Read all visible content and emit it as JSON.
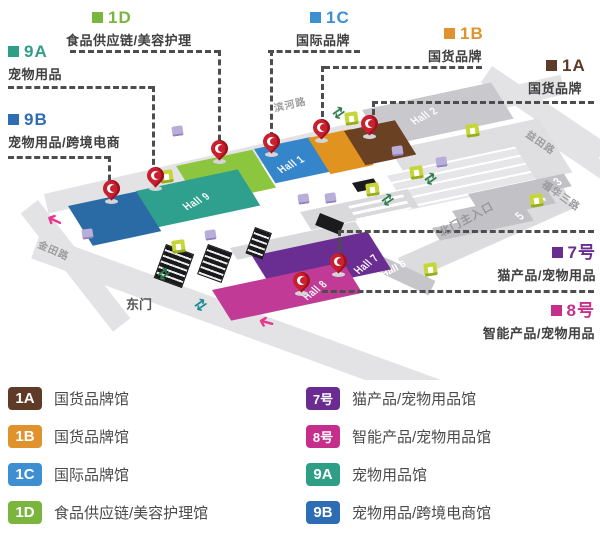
{
  "map": {
    "roads": {
      "binhe": "滨河路",
      "yitian": "益田路",
      "fuhua": "福华三路",
      "jintian": "金田路"
    },
    "gates": {
      "east": "东门",
      "north_main": "北门主入口"
    },
    "halls": {
      "h1": "Hall 1",
      "h2": "Hall 2",
      "h3": "3",
      "h4": "4",
      "h5": "5",
      "h6": "Hall 6",
      "h7": "Hall 7",
      "h8": "Hall 8",
      "h9": "Hall 9"
    },
    "annotations": {
      "a1d": {
        "code": "1D",
        "label": "食品供应链/美容护理"
      },
      "a9a": {
        "code": "9A",
        "label": "宠物用品"
      },
      "a9b": {
        "code": "9B",
        "label": "宠物用品/跨境电商"
      },
      "a1c": {
        "code": "1C",
        "label": "国际品牌"
      },
      "a1b": {
        "code": "1B",
        "label": "国货品牌"
      },
      "a1a": {
        "code": "1A",
        "label": "国货品牌"
      },
      "a7": {
        "code": "7号",
        "label": "猫产品/宠物用品"
      },
      "a8": {
        "code": "8号",
        "label": "智能产品/宠物用品"
      }
    },
    "colors": {
      "hall_1a": "#6b4123",
      "hall_1b": "#e0931f",
      "hall_1c": "#3585cb",
      "hall_1d": "#8cc63f",
      "hall_9a": "#2f9f8e",
      "hall_9b": "#2a6aa5",
      "hall_7": "#6a2e93",
      "hall_8": "#c13a96",
      "hall_gray": "#c9c9cd",
      "pin_red": "#c8202f",
      "arrow_magenta": "#e8378e",
      "gate_green": "#c6d638"
    }
  },
  "legend": {
    "left": [
      {
        "code": "1A",
        "label": "国货品牌馆"
      },
      {
        "code": "1B",
        "label": "国货品牌馆"
      },
      {
        "code": "1C",
        "label": "国际品牌馆"
      },
      {
        "code": "1D",
        "label": "食品供应链/美容护理馆"
      }
    ],
    "right": [
      {
        "code": "7号",
        "label": "猫产品/宠物用品馆"
      },
      {
        "code": "8号",
        "label": "智能产品/宠物用品馆"
      },
      {
        "code": "9A",
        "label": "宠物用品馆"
      },
      {
        "code": "9B",
        "label": "宠物用品/跨境电商馆"
      }
    ]
  }
}
